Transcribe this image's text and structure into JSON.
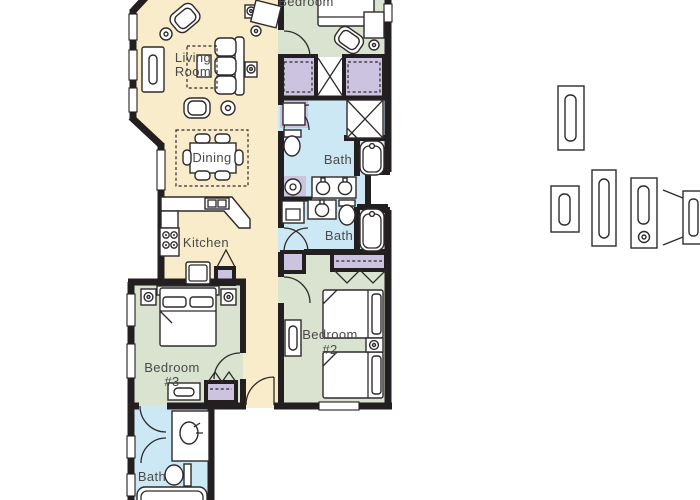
{
  "page": {
    "background": "#ffffff"
  },
  "palette": {
    "wall": "#231f20",
    "line": "#2e2a2b",
    "floor-living": "#f8ecca",
    "floor-bedroom": "#d9e3cf",
    "floor-bath": "#cbe8f4",
    "floor-closet": "#ccc3e1",
    "fixture-fill": "#ffffff",
    "label": "#4a4a4a"
  },
  "rooms": {
    "bedroom1": {
      "label": "Bedroom"
    },
    "living": {
      "line1": "Living",
      "line2": "Room"
    },
    "dining": {
      "label": "Dining"
    },
    "kitchen": {
      "label": "Kitchen"
    },
    "bath_top": {
      "label": "Bath"
    },
    "bath_middle": {
      "label": "Bath"
    },
    "bath_bottom": {
      "label": "Bath"
    },
    "bedroom2": {
      "line1": "Bedroom",
      "line2": "#2"
    },
    "bedroom3": {
      "line1": "Bedroom",
      "line2": "#3"
    }
  }
}
